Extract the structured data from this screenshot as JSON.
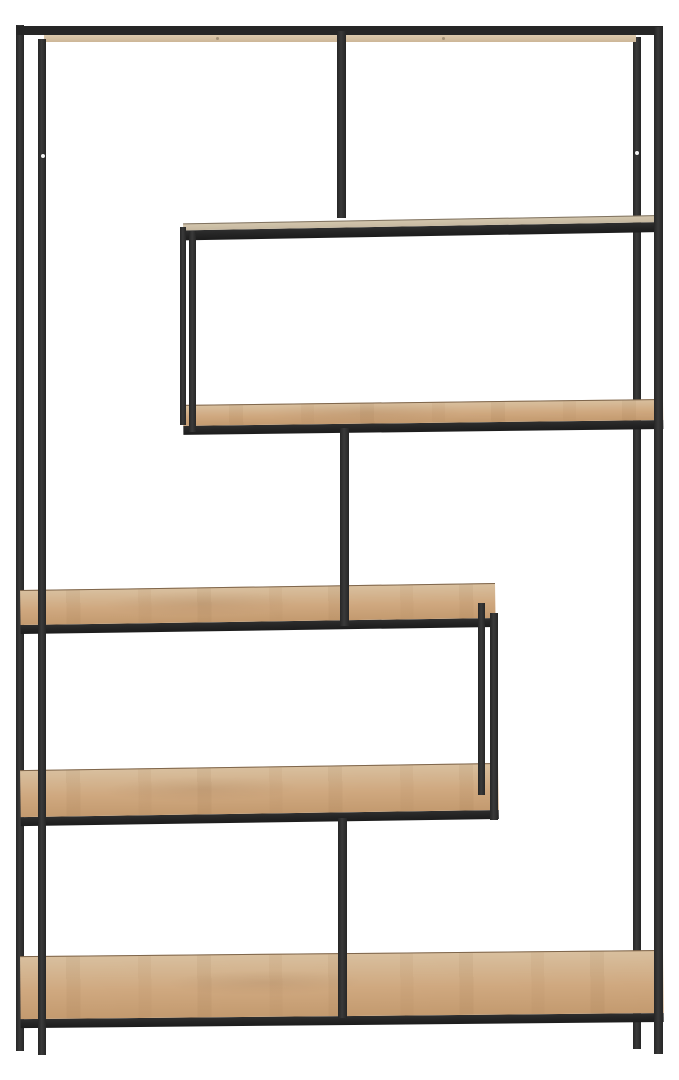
{
  "scene": {
    "type": "product-photo",
    "subject": "Asymmetric zigzag etagere bookcase with a slim black metal frame and oak-toned shelves on a white background",
    "background": "white seamless studio backdrop",
    "object_count": 1
  },
  "colors": {
    "bg": "#ffffff",
    "frame": "#262626",
    "wood-light": "#d8bf9e",
    "wood-mid": "#cfa87f",
    "wood-dark": "#c39a6f",
    "wood-sliver": "#c6b8a0",
    "wood-strip": "#dcc9ad"
  },
  "structure": {
    "frame": {
      "material": "black powder-coated metal, square tube",
      "legs": 4,
      "screw_holes_visible": 2
    },
    "shelf_count_including_top": 6,
    "shelves": [
      {
        "name": "top-rail",
        "span": "full width",
        "approx_y": 30,
        "note": "seen edge-on, wood underside strip visible"
      },
      {
        "name": "shelf-1",
        "span": "right two-thirds",
        "approx_y": 222,
        "note": "edge-on, thin wood sliver over black bar"
      },
      {
        "name": "shelf-2",
        "span": "right two-thirds",
        "approx_y": 412,
        "note": "forms closed box with shelf-1 via left support posts"
      },
      {
        "name": "shelf-3",
        "span": "left three-quarters",
        "approx_y": 605,
        "note": "top surface visible in perspective"
      },
      {
        "name": "shelf-4",
        "span": "left three-quarters",
        "approx_y": 790,
        "note": "forms closed box with shelf-3 via right support posts"
      },
      {
        "name": "bottom-shelf",
        "span": "full width",
        "approx_y": 985,
        "note": "deepest visible wood surface"
      }
    ],
    "vertical_elements": [
      {
        "name": "center-post-upper",
        "note": "top rail down to shelf-1"
      },
      {
        "name": "center-post-middle",
        "note": "shelf-2 down to shelf-3"
      },
      {
        "name": "center-post-lower",
        "note": "shelf-4 down to bottom shelf"
      },
      {
        "name": "left-support-pair",
        "note": "shelf-1 down to shelf-2"
      },
      {
        "name": "right-support-pair",
        "note": "shelf-3 down to shelf-4"
      }
    ]
  }
}
